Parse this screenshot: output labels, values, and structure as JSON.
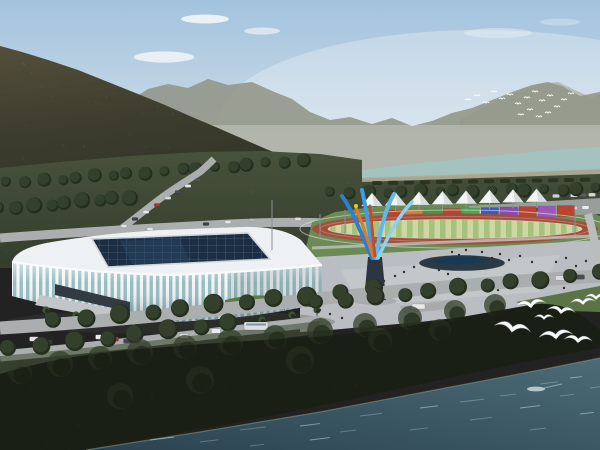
{
  "meta": {
    "type": "architectural-rendering",
    "subject": "aerial rendering of a riverside sports complex: white ribbed arena with dark glass skylight, athletics track with striped infield, white event tents, rainbow container wall, colorful flame sculpture, plaza with pedestrians, forested mountains, upper river, dark woodland shore and teal water with white birds"
  },
  "palette": {
    "sky_top": "#a3c3de",
    "sky_mid": "#c6d8e5",
    "sky_horizon": "#e3e9ea",
    "cloud": "#f6f9fa",
    "ridge_far": "#a7aa9b",
    "ridge_mid": "#93978a",
    "mountain_hi": "#7b7557",
    "mountain_mid": "#5a5a43",
    "mountain_lo": "#474d38",
    "river_upper": "#a4c2c0",
    "sand": "#b0a88f",
    "belt_hi": "#5a674a",
    "belt_lo": "#414e38",
    "tree_mid": "#33402b",
    "tree_dark": "#242e1d",
    "road": "#aaaeae",
    "road_light": "#b9bdbd",
    "pad_green": "#6c8a53",
    "track_red": "#a14e3a",
    "infield_a": "#ccd8a0",
    "infield_b": "#a6c17e",
    "fence": "#e0e4e0",
    "tent": "#f4f6f6",
    "tent_shade": "#d7dcde",
    "plaza": "#babec2",
    "plaza_light": "#c9cdd0",
    "pond": "#2a3a44",
    "pond_core": "#173a54",
    "stadium_white": "#edf1f3",
    "glass": "#98bcc0",
    "rib": "#f2f5f6",
    "skylight": "#1c2e44",
    "skylight_grid": "#4a6580",
    "berm": "#5c7a4a",
    "sculpt_b1": "#2a7fd0",
    "sculpt_b2": "#3f9ce2",
    "sculpt_b3": "#62b8ee",
    "sculpt_b4": "#8cd0f4",
    "sculpt_o1": "#e07828",
    "sculpt_o2": "#cc4a1e",
    "sculpt_y": "#f2c12e",
    "pedestal": "#2c3640",
    "water_hi": "#4c6b77",
    "water_lo": "#2b4351",
    "shore": "#93a089",
    "ripple": "#d7e6ec",
    "bird": "#fafcfc",
    "people": "#2b3036",
    "grass_fg": "#46543a",
    "lawn_right": "#5a7446",
    "lot": "#a7abac",
    "parking": "#989e9b",
    "pole": "#8a9094",
    "trunk": "#5a5148",
    "palm": "#3e5531"
  },
  "scene": {
    "clouds": [
      [
        205,
        19,
        24,
        4.5,
        0.85
      ],
      [
        164,
        57,
        30,
        5.5,
        0.8
      ],
      [
        262,
        31,
        18,
        3.5,
        0.6
      ],
      [
        498,
        33,
        34,
        5,
        0.35
      ],
      [
        560,
        22,
        20,
        3.5,
        0.3
      ]
    ],
    "distant_flock": [
      [
        468,
        100
      ],
      [
        477,
        96
      ],
      [
        486,
        103
      ],
      [
        494,
        92
      ],
      [
        502,
        99
      ],
      [
        510,
        95
      ],
      [
        518,
        104
      ],
      [
        527,
        98
      ],
      [
        535,
        92
      ],
      [
        542,
        101
      ],
      [
        550,
        96
      ],
      [
        557,
        107
      ],
      [
        564,
        100
      ],
      [
        571,
        94
      ],
      [
        548,
        113
      ],
      [
        539,
        117
      ],
      [
        530,
        110
      ],
      [
        521,
        115
      ]
    ],
    "shore_dashes": {
      "x0": 372,
      "dx": 16,
      "n": 14,
      "y0": 181,
      "dy": -0.25,
      "w": 10,
      "h": 4
    },
    "tents": {
      "count": 8,
      "x0": 372,
      "dx": 23.5,
      "base_y": 206,
      "base_dy": -0.6,
      "half_w": 10.5,
      "height": 13,
      "pole": 6
    },
    "wall_segments": {
      "x0": 386,
      "w": 17.5,
      "gap": 1.5,
      "y0": 210,
      "dy": -0.5,
      "h": 11,
      "colors": [
        "#b8452f",
        "#d2803a",
        "#3f9a4a",
        "#bf4030",
        "#4aa84e",
        "#3b57c8",
        "#8a4ab6",
        "#bf4030",
        "#9b59b6",
        "#b8452f"
      ]
    },
    "tree_rows": [
      {
        "x0": 8,
        "y0": 182,
        "x1": 300,
        "y1": 160,
        "n": 18,
        "r": 5
      },
      {
        "x0": 0,
        "y0": 208,
        "x1": 130,
        "y1": 196,
        "n": 9,
        "r": 6
      },
      {
        "x0": 332,
        "y0": 192,
        "x1": 596,
        "y1": 188,
        "n": 16,
        "r": 5
      },
      {
        "x0": 55,
        "y0": 320,
        "x1": 370,
        "y1": 288,
        "n": 11,
        "r": 8
      },
      {
        "x0": 10,
        "y0": 348,
        "x1": 230,
        "y1": 322,
        "n": 8,
        "r": 8
      },
      {
        "x0": 318,
        "y0": 302,
        "x1": 596,
        "y1": 272,
        "n": 11,
        "r": 7
      }
    ],
    "woods_canopy": [
      [
        20,
        372,
        12
      ],
      [
        60,
        364,
        13
      ],
      [
        100,
        358,
        12
      ],
      [
        140,
        352,
        13
      ],
      [
        185,
        347,
        12
      ],
      [
        230,
        342,
        13
      ],
      [
        275,
        337,
        12
      ],
      [
        320,
        331,
        13
      ],
      [
        365,
        325,
        12
      ],
      [
        410,
        318,
        12
      ],
      [
        455,
        311,
        11
      ],
      [
        495,
        305,
        11
      ],
      [
        300,
        360,
        14
      ],
      [
        200,
        380,
        14
      ],
      [
        120,
        396,
        13
      ],
      [
        380,
        340,
        12
      ],
      [
        440,
        330,
        11
      ]
    ],
    "cars_mid": [
      [
        124,
        226,
        "#dfe1e4"
      ],
      [
        135,
        219,
        "#3a4148"
      ],
      [
        146,
        212,
        "#e8e9eb"
      ],
      [
        157,
        205,
        "#b23227"
      ],
      [
        168,
        198,
        "#d9dbde"
      ],
      [
        178,
        192,
        "#454c54"
      ],
      [
        188,
        186,
        "#e3e5e7"
      ],
      [
        198,
        180,
        "#50575e"
      ],
      [
        150,
        229,
        "#e2e4e6"
      ],
      [
        206,
        224,
        "#3c434a"
      ],
      [
        228,
        222,
        "#e6e7e9"
      ],
      [
        252,
        220,
        "#b9bdc3"
      ],
      [
        298,
        219,
        "#dfe1e3"
      ]
    ],
    "cars_parked_row1": {
      "x0": 482,
      "dx": 11.5,
      "y0": 212,
      "dy": -0.5,
      "n": 10,
      "colors": [
        "#d9dbdd",
        "#3c4248",
        "#c9ccd0",
        "#7c8288",
        "#e4e6e8",
        "#51565c",
        "#d9dbdd",
        "#394047",
        "#cfd2d5",
        "#e8eaeb"
      ]
    },
    "cars_parked_row2": {
      "x0": 556,
      "dx": 9,
      "y0": 196,
      "dy": -0.3,
      "n": 5,
      "colors": [
        "#cfd2d4",
        "#454b51",
        "#dfe1e3",
        "#595f65",
        "#d4d6d8"
      ]
    },
    "cars_foreground": [
      [
        34,
        339,
        "#e2e4e6"
      ],
      [
        48,
        342,
        "#343a40"
      ],
      [
        100,
        337,
        "#e9ebec"
      ],
      [
        114,
        339,
        "#b23227"
      ],
      [
        128,
        341,
        "#3f464d"
      ],
      [
        184,
        336,
        "#dcdee0"
      ],
      [
        216,
        331,
        "#e8eaec"
      ],
      [
        560,
        278,
        "#d8dadc"
      ],
      [
        580,
        277,
        "#454b52"
      ]
    ],
    "bus": {
      "x": 244,
      "y": 322,
      "w": 24,
      "h": 8
    },
    "mini_bus": {
      "x": 412,
      "y": 304,
      "w": 13,
      "h": 5
    },
    "people": [
      [
        452,
        252
      ],
      [
        459,
        255
      ],
      [
        466,
        250
      ],
      [
        474,
        257
      ],
      [
        482,
        252
      ],
      [
        492,
        258
      ],
      [
        500,
        254
      ],
      [
        509,
        260
      ],
      [
        520,
        256
      ],
      [
        532,
        262
      ],
      [
        414,
        267
      ],
      [
        404,
        272
      ],
      [
        395,
        276
      ],
      [
        384,
        281
      ],
      [
        373,
        286
      ],
      [
        362,
        291
      ],
      [
        350,
        296
      ],
      [
        338,
        301
      ],
      [
        439,
        270
      ],
      [
        448,
        274
      ],
      [
        458,
        279
      ],
      [
        470,
        283
      ],
      [
        484,
        287
      ],
      [
        498,
        290
      ],
      [
        556,
        262
      ],
      [
        566,
        258
      ],
      [
        576,
        266
      ],
      [
        586,
        261
      ],
      [
        540,
        280
      ],
      [
        552,
        284
      ],
      [
        564,
        288
      ],
      [
        320,
        310
      ],
      [
        330,
        314
      ],
      [
        342,
        318
      ],
      [
        200,
        318
      ],
      [
        215,
        320
      ],
      [
        228,
        316
      ],
      [
        310,
        306
      ],
      [
        322,
        303
      ]
    ],
    "palms": [
      [
        46,
        316
      ],
      [
        76,
        321
      ],
      [
        106,
        326
      ],
      [
        136,
        330
      ],
      [
        167,
        333
      ],
      [
        199,
        333
      ],
      [
        231,
        330
      ],
      [
        262,
        326
      ],
      [
        292,
        321
      ],
      [
        317,
        316
      ]
    ],
    "birds_foreground": [
      [
        531,
        307,
        1.1,
        -8
      ],
      [
        561,
        313,
        1.0,
        6
      ],
      [
        583,
        304,
        0.9,
        -4
      ],
      [
        512,
        331,
        1.3,
        10
      ],
      [
        556,
        338,
        1.2,
        -6
      ],
      [
        578,
        342,
        1.0,
        4
      ],
      [
        596,
        299,
        0.8,
        0
      ],
      [
        544,
        319,
        0.7,
        0
      ]
    ],
    "ripples": [
      [
        150,
        440,
        24
      ],
      [
        200,
        442,
        18
      ],
      [
        240,
        430,
        26
      ],
      [
        300,
        426,
        20
      ],
      [
        340,
        432,
        16
      ],
      [
        360,
        416,
        22
      ],
      [
        420,
        408,
        18
      ],
      [
        460,
        402,
        24
      ],
      [
        500,
        396,
        16
      ],
      [
        520,
        408,
        20
      ],
      [
        540,
        384,
        18
      ],
      [
        560,
        396,
        14
      ],
      [
        570,
        378,
        12
      ],
      [
        470,
        420,
        22
      ],
      [
        410,
        430,
        18
      ],
      [
        310,
        440,
        20
      ],
      [
        250,
        446,
        14
      ],
      [
        530,
        430,
        16
      ],
      [
        580,
        414,
        14
      ],
      [
        590,
        388,
        10
      ]
    ]
  }
}
